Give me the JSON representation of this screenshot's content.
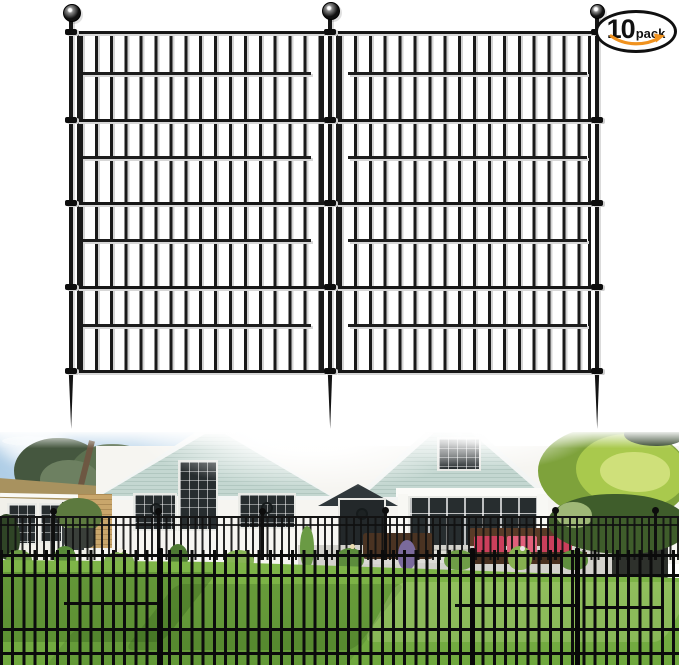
{
  "badge": {
    "count": "10",
    "unit": "pack"
  },
  "icons": {
    "badge_arrow": "amazon-smile-arrow",
    "post_top": "ball-finial",
    "post_bottom": "ground-spike"
  },
  "product_drawing": {
    "posts_visible": 3,
    "panels_visible": 2
  },
  "colors": {
    "badge_border": "#101010",
    "badge_arrow_orange": "#F0921E",
    "fence_metal": "#161616",
    "house_siding_sage": "#BFD3CC",
    "house_wall_white": "#F6F5F1",
    "sky_blue": "#AECDE6",
    "grass_green": "#7CB347",
    "grass_shadow": "#4F7D33",
    "sofa_wicker_brown": "#5A3B27",
    "cushion_red": "#CB3F5C",
    "roof_tan": "#A8925F"
  }
}
